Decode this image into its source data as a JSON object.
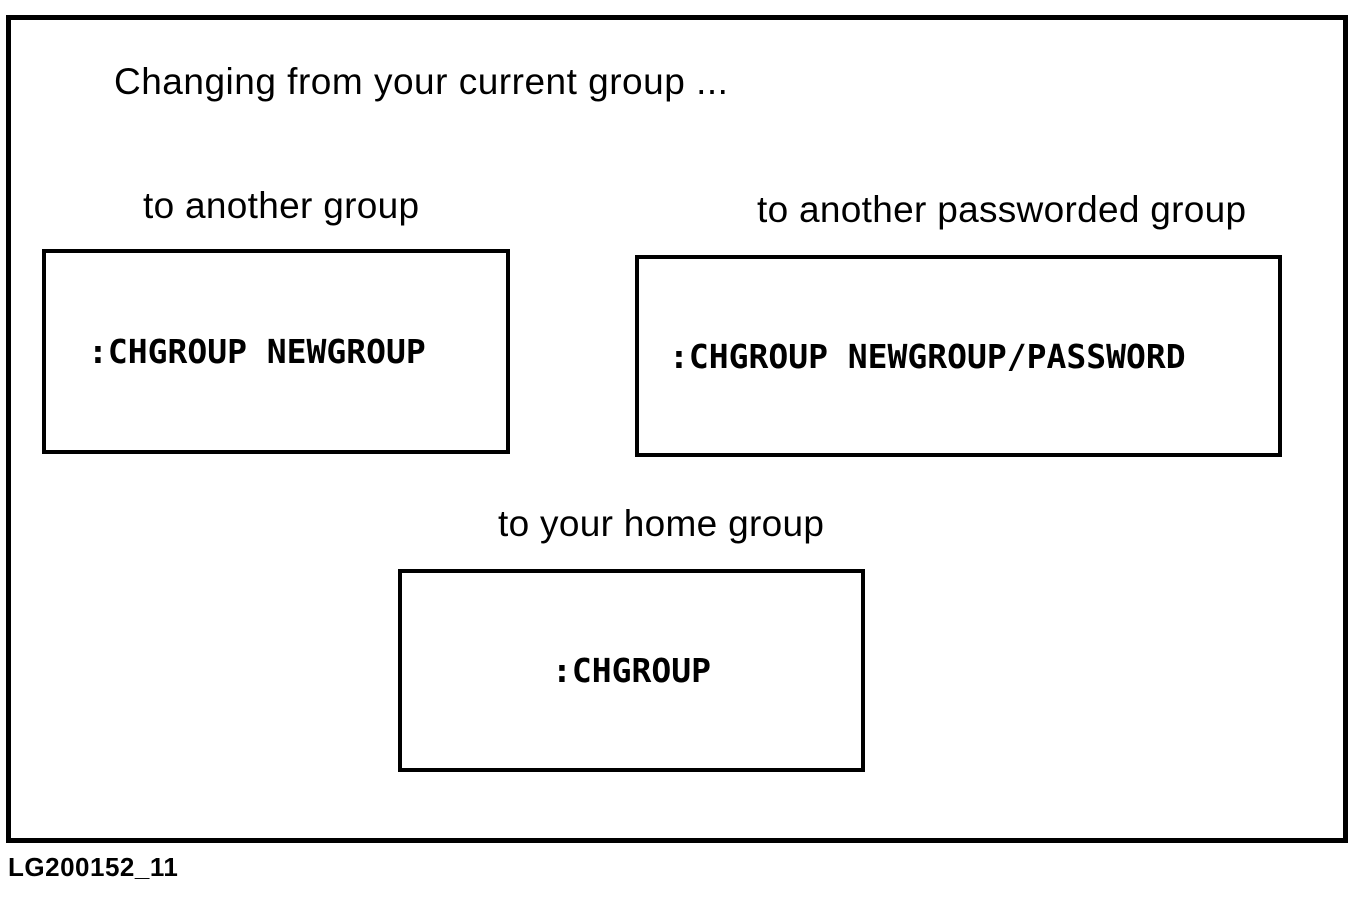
{
  "figure": {
    "title": "Changing from your current group ...",
    "caption": "LG200152_11",
    "boxes": [
      {
        "id": "another-group",
        "label": "to another group",
        "command": ":CHGROUP NEWGROUP"
      },
      {
        "id": "another-passworded-group",
        "label": "to another passworded group",
        "command": ":CHGROUP NEWGROUP/PASSWORD"
      },
      {
        "id": "home-group",
        "label": "to your home group",
        "command": ":CHGROUP"
      }
    ],
    "colors": {
      "ink": "#000000",
      "paper": "#ffffff"
    }
  }
}
